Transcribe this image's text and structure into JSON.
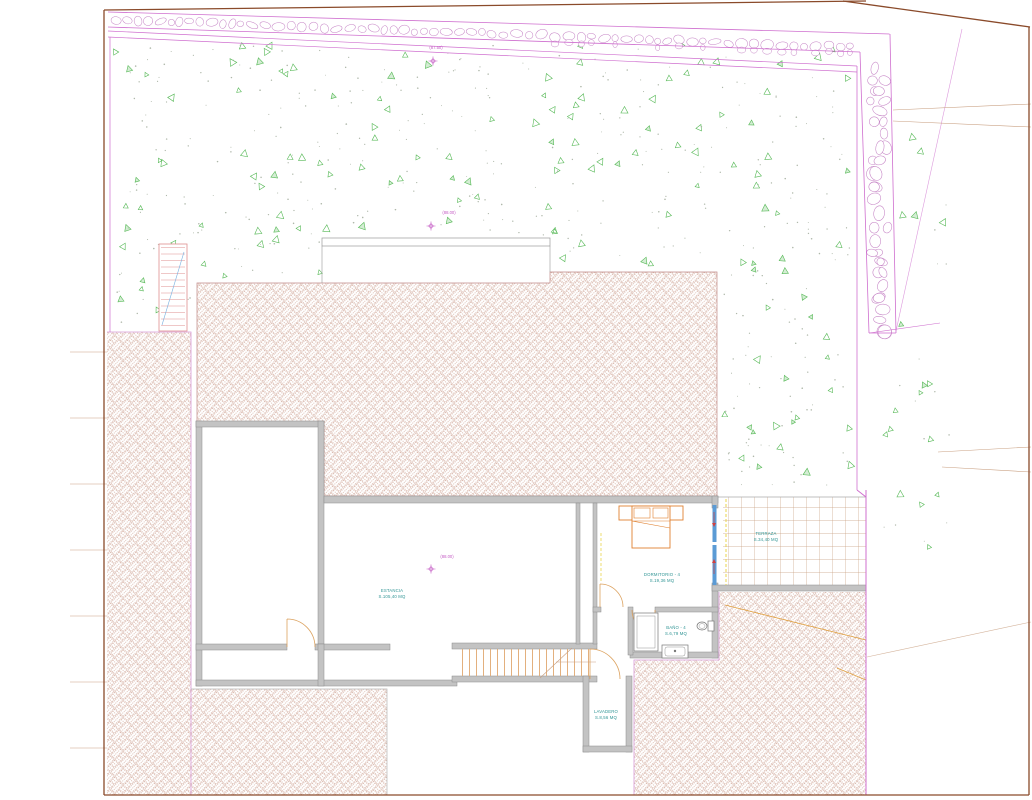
{
  "drawing": {
    "elevations": [
      {
        "label": "(87.50)"
      },
      {
        "label": "(88.00)"
      },
      {
        "label": "(88.00)"
      }
    ],
    "rooms": [
      {
        "name": "ESTANCIA",
        "area": "S.105,40 MQ"
      },
      {
        "name": "DORMITORIO - 4",
        "area": "S.19,36 MQ"
      },
      {
        "name": "BAÑO - 4",
        "area": "S.6,79 MQ"
      },
      {
        "name": "LAVADERO",
        "area": "S.8,56 MQ"
      },
      {
        "name": "TERRAZA",
        "area": "S.34,40 MQ"
      }
    ],
    "colors": {
      "sheet_border": "#8a4a2a",
      "boundary": "#cf6fcf",
      "boundary_light": "#d79ad7",
      "stone": "#c583c5",
      "vegetation": "#55b855",
      "dot": "#a0aa9a",
      "hatch": "#cfa596",
      "hatch_edge": "#c08987",
      "wall_fill": "#c3c3c3",
      "wall_edge": "#8c8c8c",
      "furniture": "#e08030",
      "stair": "#e09090",
      "tread": "#e0a870",
      "window": "#5b9bd5",
      "arrow": "#d04040",
      "dashed": "#e8d44d",
      "grid": "#c9a082",
      "label": "#2f9494",
      "elevation": "#c45ac4"
    }
  }
}
